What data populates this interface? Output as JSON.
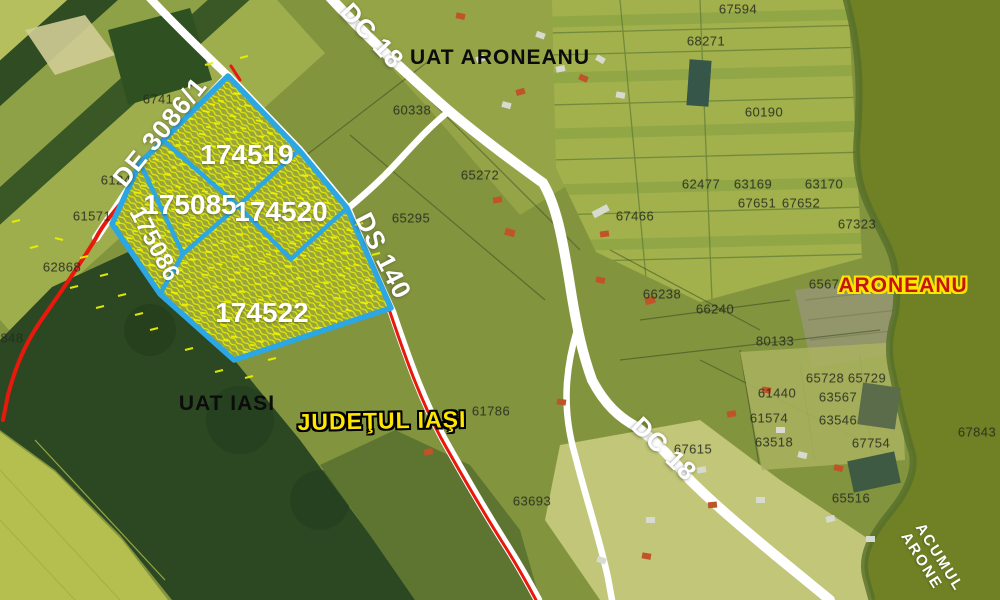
{
  "map": {
    "highlighted_parcels": [
      {
        "text": "174519",
        "x": 247,
        "y": 155,
        "rot": 0,
        "cls": "hl"
      },
      {
        "text": "175085",
        "x": 190,
        "y": 205,
        "rot": 0,
        "cls": "hl"
      },
      {
        "text": "174520",
        "x": 281,
        "y": 212,
        "rot": 0,
        "cls": "hl"
      },
      {
        "text": "175086",
        "x": 154,
        "y": 244,
        "rot": 62,
        "cls": "hl-small"
      },
      {
        "text": "174522",
        "x": 262,
        "y": 313,
        "rot": 0,
        "cls": "hl"
      }
    ],
    "road_labels": [
      {
        "text": "DC 18",
        "x": 372,
        "y": 36,
        "rot": 47
      },
      {
        "text": "DE 3086/1",
        "x": 160,
        "y": 132,
        "rot": -51
      },
      {
        "text": "DS 140",
        "x": 383,
        "y": 256,
        "rot": 63
      },
      {
        "text": "DC 18",
        "x": 664,
        "y": 449,
        "rot": 44
      }
    ],
    "area_labels": [
      {
        "text": "UAT ARONEANU",
        "x": 500,
        "y": 58,
        "rot": 0,
        "cls": "uat"
      },
      {
        "text": "UAT IASI",
        "x": 227,
        "y": 404,
        "rot": 0,
        "cls": "uat"
      },
      {
        "text": "JUDEŢUL IAŞI",
        "x": 382,
        "y": 421,
        "rot": -1,
        "cls": "judet"
      },
      {
        "text": "ARONEANU",
        "x": 903,
        "y": 286,
        "rot": 0,
        "cls": "village"
      }
    ],
    "lake_label": {
      "line1": "ACUMUL",
      "line2": "ARONE",
      "x": 932,
      "y": 562,
      "rot": 58
    },
    "parcel_numbers": [
      {
        "text": "67594",
        "x": 738,
        "y": 9
      },
      {
        "text": "68271",
        "x": 706,
        "y": 41
      },
      {
        "text": "60190",
        "x": 764,
        "y": 112
      },
      {
        "text": "60338",
        "x": 412,
        "y": 110
      },
      {
        "text": "6741",
        "x": 158,
        "y": 99
      },
      {
        "text": "65272",
        "x": 480,
        "y": 175
      },
      {
        "text": "65295",
        "x": 411,
        "y": 218
      },
      {
        "text": "62477",
        "x": 701,
        "y": 184
      },
      {
        "text": "63169",
        "x": 753,
        "y": 184
      },
      {
        "text": "63170",
        "x": 824,
        "y": 184
      },
      {
        "text": "67651",
        "x": 757,
        "y": 203
      },
      {
        "text": "67652",
        "x": 801,
        "y": 203
      },
      {
        "text": "67466",
        "x": 635,
        "y": 216
      },
      {
        "text": "67323",
        "x": 857,
        "y": 224
      },
      {
        "text": "65672",
        "x": 828,
        "y": 284
      },
      {
        "text": "66238",
        "x": 662,
        "y": 294
      },
      {
        "text": "66240",
        "x": 715,
        "y": 309
      },
      {
        "text": "80133",
        "x": 775,
        "y": 341
      },
      {
        "text": "65728",
        "x": 825,
        "y": 378
      },
      {
        "text": "65729",
        "x": 867,
        "y": 378
      },
      {
        "text": "61440",
        "x": 777,
        "y": 393
      },
      {
        "text": "63567",
        "x": 838,
        "y": 397
      },
      {
        "text": "61574",
        "x": 769,
        "y": 418
      },
      {
        "text": "63546",
        "x": 838,
        "y": 420
      },
      {
        "text": "63518",
        "x": 774,
        "y": 442
      },
      {
        "text": "67754",
        "x": 871,
        "y": 443
      },
      {
        "text": "67843",
        "x": 977,
        "y": 432
      },
      {
        "text": "67615",
        "x": 693,
        "y": 449
      },
      {
        "text": "65516",
        "x": 851,
        "y": 498
      },
      {
        "text": "61786",
        "x": 491,
        "y": 411
      },
      {
        "text": "63693",
        "x": 532,
        "y": 501
      },
      {
        "text": "61571",
        "x": 92,
        "y": 216
      },
      {
        "text": "62868",
        "x": 62,
        "y": 267
      },
      {
        "text": "6124",
        "x": 116,
        "y": 180
      },
      {
        "text": "848",
        "x": 12,
        "y": 338
      }
    ],
    "colors": {
      "highlight_outline": "#2ba7e4",
      "hatch_yellow": "#e8f000",
      "boundary_red": "#e8190c",
      "road_white": "#ffffff",
      "lake_green": "#6f8124"
    }
  }
}
